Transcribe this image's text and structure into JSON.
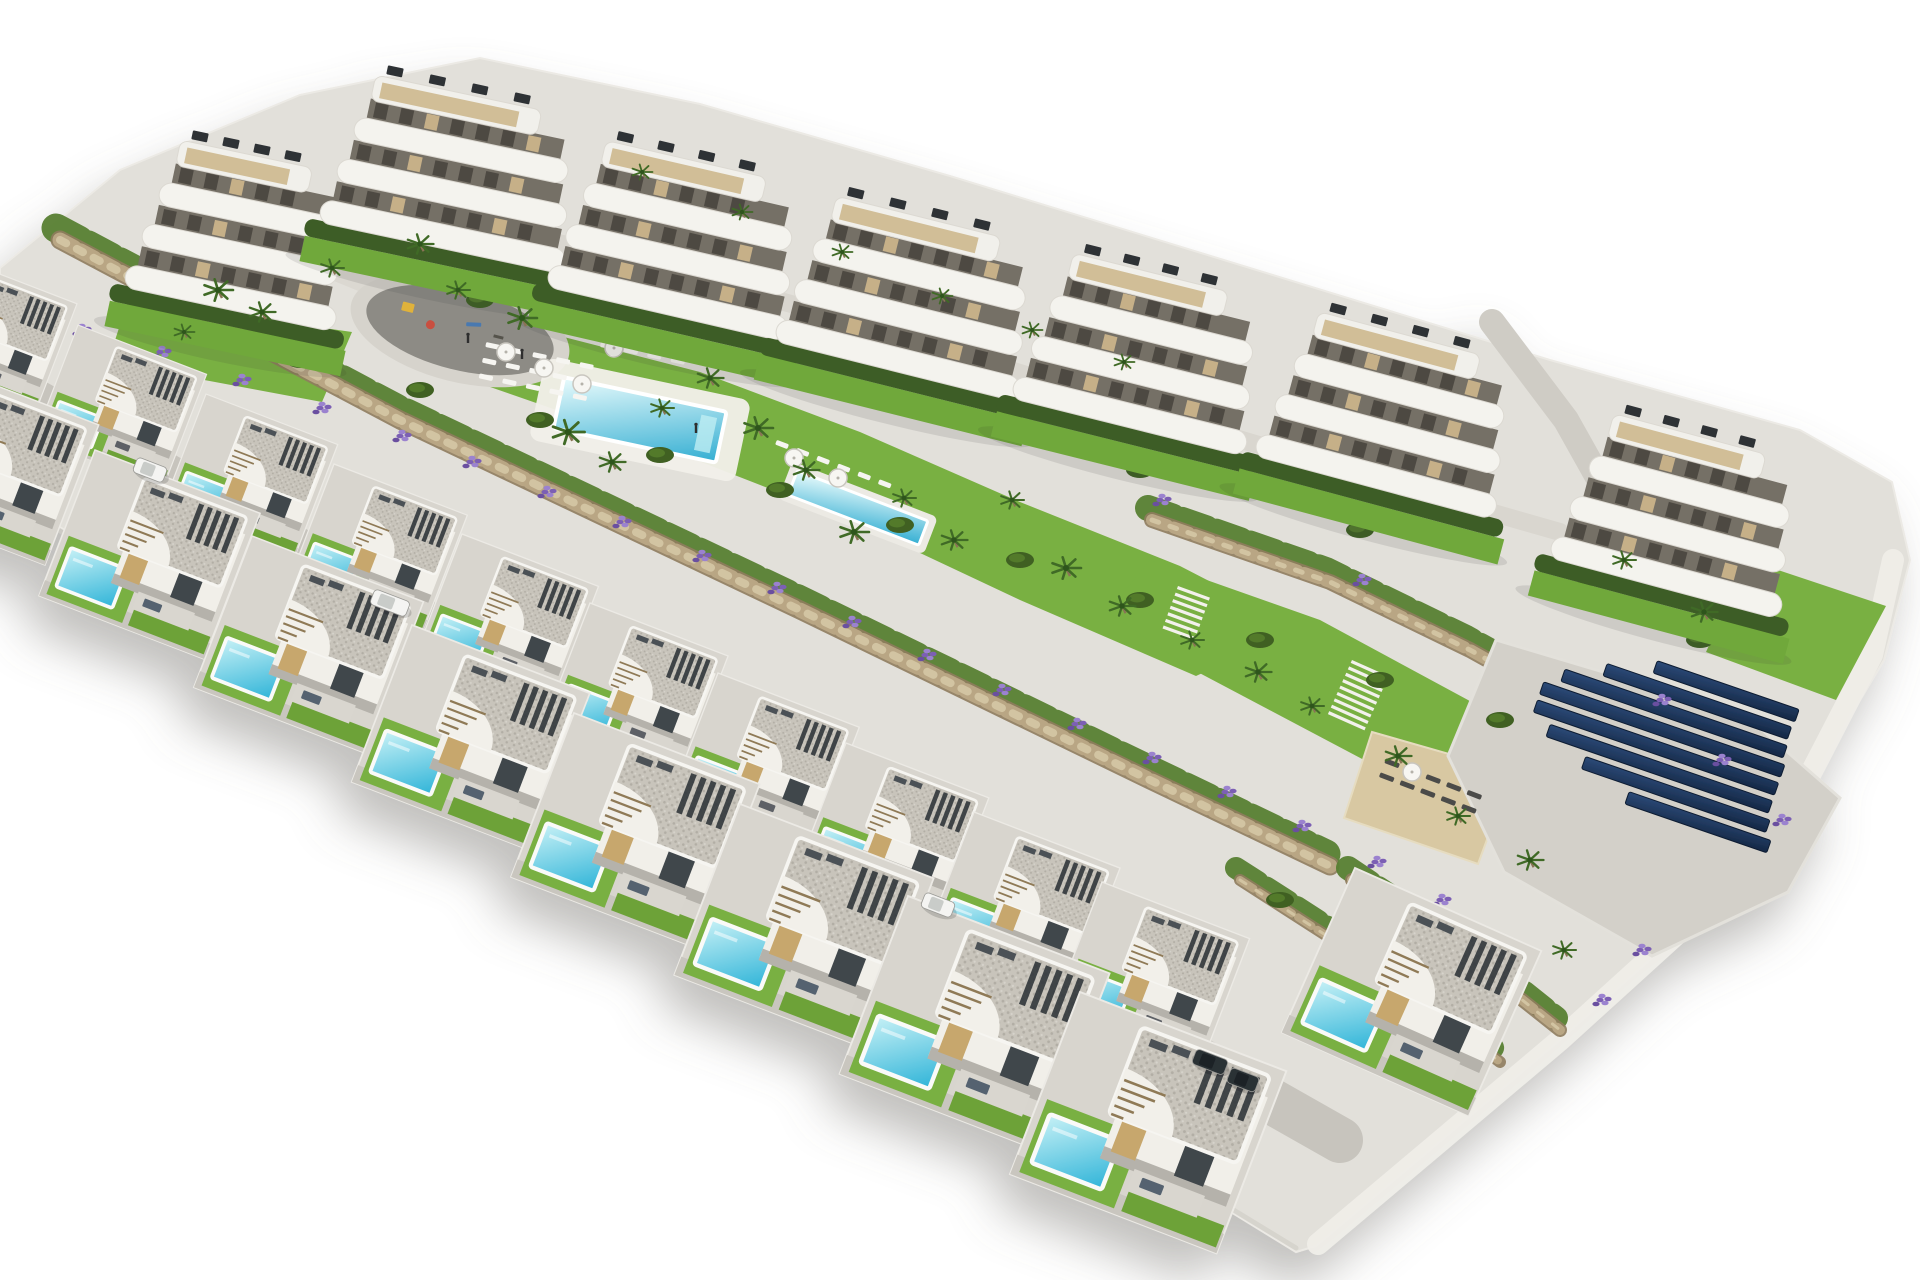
{
  "scene_type": "aerial-architectural-render-residential-development",
  "canvas": {
    "w": 1920,
    "h": 1280
  },
  "palette": {
    "background": "#ffffff",
    "concrete": "#d8d5ce",
    "concrete_light": "#e2e0da",
    "road": "#c7c4bd",
    "kerb": "#efede8",
    "wall_white": "#f1efe9",
    "wall_shadow": "#b5b2ab",
    "roof_base": "#c8c4bb",
    "roof_dot_dark": "#b2aea5",
    "roof_dot_light": "#d6d3cb",
    "beige": "#c7a76d",
    "glass": "#40464b",
    "slat": "#33383d",
    "patio": "#d9d6cf",
    "sofa_front": "#54626f",
    "sofa_back": "#5d6166",
    "lawn": "#79b043",
    "lawn_dark": "#6da239",
    "hedge": "#3e5d26",
    "bush": "#3f6023",
    "bush_light": "#527a2c",
    "band_green": "#577f31",
    "stone_dark": "#8f7c5e",
    "stone": "#b9a684",
    "stone_light": "#d2c4a2",
    "lavender": "#7b5fb4",
    "lavender_light": "#9b82cf",
    "lavender_dark": "#6a4fa0",
    "pool_hi": "#c7f1f6",
    "pool_lo": "#2fb4d8",
    "mpool_hi": "#e9fbfc",
    "mpool_lo": "#33aed2",
    "pool_rim": "#fafaf8",
    "sand": "#d8c8a2",
    "plaza": "#8d8b85",
    "solar_hi": "#2c4a78",
    "solar_lo": "#142744",
    "solar_edge": "#0f1e33",
    "palm": "#3f6b26",
    "palm_dark": "#2f541c",
    "trunk": "#8a7356",
    "white_item": "#f6f5f1",
    "dark_item": "#4b4b49",
    "stair_brown": "#8f7a57",
    "interior": "#756f66",
    "slot": "#4d4942",
    "furn_beige": "#c6b088",
    "deck": "#cdb88e",
    "ac": "#2e3236",
    "car_white": "#f4f4f2",
    "car_white_top": "#c9ccc9",
    "car_dark": "#2c3136",
    "car_dark_top": "#1d2126",
    "shadow": "#76746e",
    "figure": "#2e2e2e",
    "play_yellow": "#e0b23a",
    "play_red": "#c94f3f",
    "play_blue": "#4a79b0"
  },
  "site": {
    "outline": [
      [
        0,
        268
      ],
      [
        120,
        170
      ],
      [
        300,
        95
      ],
      [
        480,
        58
      ],
      [
        700,
        104
      ],
      [
        950,
        176
      ],
      [
        1250,
        268
      ],
      [
        1550,
        360
      ],
      [
        1800,
        430
      ],
      [
        1892,
        482
      ],
      [
        1910,
        560
      ],
      [
        1884,
        660
      ],
      [
        1800,
        800
      ],
      [
        1690,
        924
      ],
      [
        1560,
        1040
      ],
      [
        1430,
        1150
      ],
      [
        1316,
        1246
      ],
      [
        1296,
        1252
      ],
      [
        1000,
        1070
      ],
      [
        650,
        868
      ],
      [
        300,
        668
      ],
      [
        0,
        492
      ]
    ],
    "right_edge": [
      [
        1893,
        560
      ],
      [
        1872,
        655
      ],
      [
        1798,
        798
      ],
      [
        1690,
        922
      ],
      [
        1560,
        1040
      ],
      [
        1432,
        1148
      ],
      [
        1318,
        1244
      ]
    ],
    "bottom_edge": [
      [
        0,
        496
      ],
      [
        300,
        670
      ],
      [
        650,
        868
      ],
      [
        1000,
        1068
      ],
      [
        1296,
        1248
      ]
    ]
  },
  "paths": {
    "upper": {
      "pts": [
        [
          350,
          198
        ],
        [
          600,
          252
        ],
        [
          850,
          320
        ],
        [
          1100,
          398
        ],
        [
          1350,
          472
        ],
        [
          1560,
          532
        ]
      ],
      "w": 18
    },
    "main": {
      "pts": [
        [
          310,
          255
        ],
        [
          420,
          300
        ],
        [
          540,
          350
        ],
        [
          660,
          402
        ],
        [
          780,
          452
        ],
        [
          900,
          502
        ],
        [
          1020,
          552
        ],
        [
          1140,
          602
        ],
        [
          1268,
          654
        ]
      ],
      "w": 30
    },
    "right_road": {
      "pts": [
        [
          1492,
          322
        ],
        [
          1566,
          420
        ],
        [
          1622,
          520
        ],
        [
          1644,
          606
        ]
      ],
      "w": 26
    },
    "villa_road": {
      "pts": [
        [
          -20,
          371
        ],
        [
          300,
          552
        ],
        [
          700,
          778
        ],
        [
          1100,
          1004
        ],
        [
          1340,
          1140
        ]
      ],
      "w": 46
    }
  },
  "lawns": [
    {
      "name": "amenity-lawn",
      "pts": [
        [
          418,
          298
        ],
        [
          560,
          336
        ],
        [
          700,
          372
        ],
        [
          860,
          432
        ],
        [
          1020,
          502
        ],
        [
          1180,
          566
        ],
        [
          1300,
          628
        ],
        [
          1196,
          676
        ],
        [
          1020,
          600
        ],
        [
          850,
          520
        ],
        [
          660,
          446
        ],
        [
          470,
          380
        ],
        [
          404,
          340
        ]
      ]
    },
    {
      "name": "east-lawn",
      "pts": [
        [
          1150,
          560
        ],
        [
          1320,
          620
        ],
        [
          1468,
          700
        ],
        [
          1560,
          760
        ],
        [
          1470,
          816
        ],
        [
          1330,
          742
        ],
        [
          1190,
          668
        ],
        [
          1108,
          612
        ]
      ]
    },
    {
      "name": "block-a-lawn",
      "pts": [
        [
          128,
          300
        ],
        [
          352,
          332
        ],
        [
          322,
          402
        ],
        [
          108,
          362
        ]
      ]
    },
    {
      "name": "far-right-lawn",
      "pts": [
        [
          1748,
          560
        ],
        [
          1886,
          606
        ],
        [
          1836,
          700
        ],
        [
          1706,
          652
        ]
      ]
    }
  ],
  "walls": [
    {
      "pts": [
        [
          60,
          240
        ],
        [
          400,
          420
        ],
        [
          800,
          610
        ],
        [
          1150,
          780
        ],
        [
          1330,
          866
        ]
      ],
      "w": 15
    },
    {
      "pts": [
        [
          1152,
          520
        ],
        [
          1330,
          582
        ],
        [
          1470,
          650
        ],
        [
          1560,
          700
        ]
      ],
      "w": 12
    },
    {
      "pts": [
        [
          1352,
          880
        ],
        [
          1472,
          960
        ],
        [
          1560,
          1030
        ]
      ],
      "w": 10
    },
    {
      "pts": [
        [
          1240,
          880
        ],
        [
          1380,
          970
        ],
        [
          1500,
          1062
        ]
      ],
      "w": 8
    }
  ],
  "sand_pad": {
    "pts": [
      [
        1372,
        732
      ],
      [
        1512,
        772
      ],
      [
        1478,
        864
      ],
      [
        1344,
        818
      ]
    ]
  },
  "solar": {
    "pad": [
      [
        1496,
        640
      ],
      [
        1744,
        714
      ],
      [
        1840,
        798
      ],
      [
        1788,
        892
      ],
      [
        1652,
        956
      ],
      [
        1504,
        872
      ],
      [
        1448,
        756
      ]
    ],
    "cx": 1660,
    "cy": 742,
    "angle": 19,
    "row_h": 13,
    "row_step": 19,
    "lengths": [
      150,
      195,
      235,
      255,
      255,
      235,
      195,
      150
    ],
    "offsets": [
      46,
      22,
      4,
      -2,
      -2,
      8,
      32,
      62
    ]
  },
  "pools": {
    "main": {
      "cx": 640,
      "cy": 420,
      "angle": 12,
      "deck_w": 210,
      "deck_h": 84,
      "w": 166,
      "h": 52
    },
    "lap": {
      "cx": 858,
      "cy": 508,
      "angle": 21,
      "deck_w": 156,
      "deck_h": 40,
      "w": 140,
      "h": 26
    }
  },
  "playground": {
    "cx": 460,
    "cy": 330,
    "angle": 14,
    "rx": 96,
    "ry": 40
  },
  "figures": [
    [
      468,
      338
    ],
    [
      522,
      354
    ],
    [
      696,
      428
    ]
  ],
  "stairs": [
    {
      "x": 1352,
      "y": 660,
      "angle": 24,
      "n": 9,
      "w": 40
    },
    {
      "x": 1178,
      "y": 586,
      "angle": 20,
      "n": 7,
      "w": 34
    }
  ],
  "lounger_areas": [
    {
      "cx": 540,
      "cy": 378,
      "angle": 12,
      "rows": 3,
      "cols": 5,
      "dx": 24,
      "dy": 16,
      "w": 14,
      "h": 5,
      "color_key": "white_item"
    },
    {
      "cx": 648,
      "cy": 352,
      "angle": 12,
      "rows": 2,
      "cols": 4,
      "dx": 24,
      "dy": 16,
      "w": 14,
      "h": 5,
      "color_key": "white_item"
    },
    {
      "cx": 836,
      "cy": 470,
      "angle": 21,
      "rows": 1,
      "cols": 6,
      "dx": 22,
      "dy": 14,
      "w": 13,
      "h": 5,
      "color_key": "white_item"
    },
    {
      "cx": 1432,
      "cy": 792,
      "angle": 21,
      "rows": 2,
      "cols": 5,
      "dx": 22,
      "dy": 15,
      "w": 15,
      "h": 5,
      "color_key": "dark_item"
    }
  ],
  "parasols": [
    [
      506,
      352
    ],
    [
      544,
      368
    ],
    [
      582,
      384
    ],
    [
      614,
      348
    ],
    [
      794,
      458
    ],
    [
      838,
      478
    ],
    [
      1412,
      772
    ]
  ],
  "apartment_blocks": [
    {
      "x": 150,
      "y": 160,
      "w": 215,
      "angle": 12
    },
    {
      "x": 345,
      "y": 95,
      "w": 250,
      "angle": 12
    },
    {
      "x": 575,
      "y": 160,
      "w": 245,
      "angle": 13
    },
    {
      "x": 805,
      "y": 215,
      "w": 250,
      "angle": 14
    },
    {
      "x": 1042,
      "y": 272,
      "w": 240,
      "angle": 14
    },
    {
      "x": 1287,
      "y": 330,
      "w": 248,
      "angle": 15
    },
    {
      "x": 1582,
      "y": 432,
      "w": 238,
      "angle": 15
    }
  ],
  "villas": {
    "back_row": [
      [
        -50,
        255,
        0.8
      ],
      [
        78,
        325,
        0.81
      ],
      [
        206,
        394,
        0.83
      ],
      [
        334,
        464,
        0.84
      ],
      [
        462,
        534,
        0.86
      ],
      [
        590,
        603,
        0.87
      ],
      [
        718,
        673,
        0.89
      ],
      [
        846,
        743,
        0.9
      ],
      [
        974,
        812,
        0.92
      ],
      [
        1102,
        882,
        0.93
      ]
    ],
    "front_row": [
      [
        -60,
        364,
        1.0
      ],
      [
        95,
        450,
        1.04
      ],
      [
        252,
        536,
        1.08
      ],
      [
        412,
        625,
        1.12
      ],
      [
        574,
        713,
        1.17
      ],
      [
        740,
        804,
        1.22
      ],
      [
        908,
        896,
        1.27
      ],
      [
        1080,
        992,
        1.3
      ],
      [
        1355,
        868,
        1.2
      ]
    ],
    "angle": 21,
    "last_front_angle": 24
  },
  "cars": [
    {
      "x": 150,
      "y": 470,
      "angle": 21,
      "kind": "white",
      "len": 32
    },
    {
      "x": 390,
      "y": 603,
      "angle": 21,
      "kind": "white",
      "len": 38
    },
    {
      "x": 938,
      "y": 905,
      "angle": 21,
      "kind": "white",
      "len": 32
    },
    {
      "x": 1210,
      "y": 1062,
      "angle": 21,
      "kind": "dark",
      "len": 34
    },
    {
      "x": 1243,
      "y": 1080,
      "angle": 21,
      "kind": "dark",
      "len": 30
    }
  ],
  "palms": [
    [
      218,
      290,
      1
    ],
    [
      262,
      312,
      0.9
    ],
    [
      332,
      268,
      0.8
    ],
    [
      420,
      244,
      0.9
    ],
    [
      458,
      290,
      0.8
    ],
    [
      522,
      318,
      1
    ],
    [
      568,
      432,
      1.1
    ],
    [
      612,
      462,
      0.9
    ],
    [
      662,
      408,
      0.8
    ],
    [
      710,
      378,
      0.9
    ],
    [
      758,
      428,
      1
    ],
    [
      806,
      470,
      0.9
    ],
    [
      854,
      532,
      1
    ],
    [
      904,
      498,
      0.8
    ],
    [
      954,
      540,
      0.9
    ],
    [
      1012,
      500,
      0.8
    ],
    [
      1066,
      568,
      1
    ],
    [
      1122,
      606,
      0.9
    ],
    [
      1192,
      640,
      0.8
    ],
    [
      1258,
      672,
      0.9
    ],
    [
      1312,
      706,
      0.8
    ],
    [
      1398,
      756,
      0.9
    ],
    [
      1458,
      816,
      0.8
    ],
    [
      1530,
      860,
      0.9
    ],
    [
      1564,
      950,
      0.8
    ],
    [
      1624,
      560,
      0.8
    ],
    [
      1704,
      612,
      0.9
    ],
    [
      1124,
      362,
      0.7
    ],
    [
      1032,
      330,
      0.7
    ],
    [
      942,
      296,
      0.7
    ],
    [
      842,
      252,
      0.7
    ],
    [
      742,
      212,
      0.7
    ],
    [
      642,
      172,
      0.7
    ],
    [
      184,
      332,
      0.7
    ]
  ],
  "lavender": [
    [
      160,
      352
    ],
    [
      240,
      380
    ],
    [
      320,
      408
    ],
    [
      400,
      436
    ],
    [
      470,
      462
    ],
    [
      545,
      492
    ],
    [
      620,
      522
    ],
    [
      700,
      556
    ],
    [
      775,
      588
    ],
    [
      850,
      622
    ],
    [
      925,
      655
    ],
    [
      1000,
      690
    ],
    [
      1075,
      724
    ],
    [
      1150,
      758
    ],
    [
      1225,
      792
    ],
    [
      1300,
      826
    ],
    [
      1375,
      862
    ],
    [
      1440,
      900
    ],
    [
      1500,
      940
    ],
    [
      80,
      330
    ],
    [
      350,
      260
    ],
    [
      560,
      300
    ],
    [
      760,
      350
    ],
    [
      960,
      420
    ],
    [
      1160,
      500
    ],
    [
      1360,
      580
    ],
    [
      1660,
      700
    ],
    [
      1720,
      760
    ],
    [
      1780,
      820
    ],
    [
      1600,
      1000
    ],
    [
      1640,
      950
    ]
  ],
  "bushes": [
    [
      200,
      330
    ],
    [
      300,
      360
    ],
    [
      420,
      390
    ],
    [
      540,
      420
    ],
    [
      660,
      455
    ],
    [
      780,
      490
    ],
    [
      900,
      525
    ],
    [
      1020,
      560
    ],
    [
      1140,
      600
    ],
    [
      1260,
      640
    ],
    [
      1380,
      680
    ],
    [
      1500,
      720
    ],
    [
      250,
      250
    ],
    [
      480,
      300
    ],
    [
      700,
      350
    ],
    [
      920,
      410
    ],
    [
      1140,
      470
    ],
    [
      1360,
      530
    ],
    [
      1580,
      590
    ],
    [
      1700,
      640
    ],
    [
      1280,
      900
    ],
    [
      1340,
      940
    ],
    [
      1420,
      1000
    ],
    [
      1480,
      1046
    ]
  ]
}
